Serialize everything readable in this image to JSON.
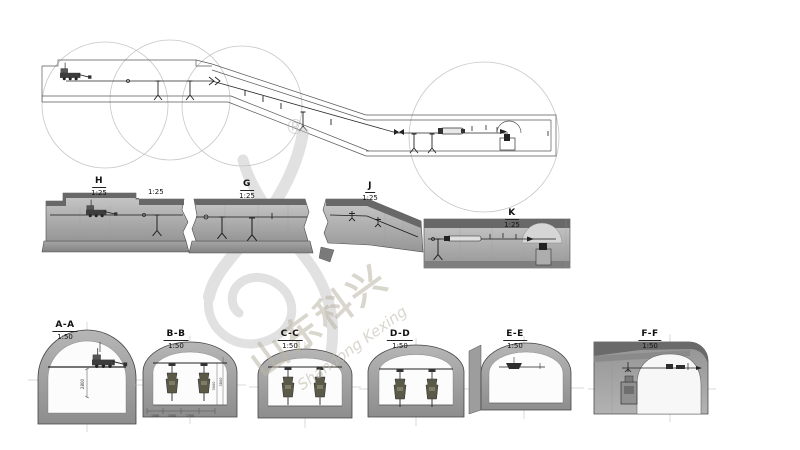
{
  "watermark": {
    "registered_mark": "®",
    "brand_cn": "山东科兴",
    "brand_en": "Shandong Kexing"
  },
  "plan": {
    "extra_scale_label": "1:25"
  },
  "detail_sections": [
    {
      "title": "H",
      "scale": "1:25"
    },
    {
      "title": "G",
      "scale": "1:25"
    },
    {
      "title": "J",
      "scale": "1:25"
    },
    {
      "title": "K",
      "scale": "1:25"
    }
  ],
  "cross_sections": [
    {
      "title": "A-A",
      "scale": "1:50"
    },
    {
      "title": "B-B",
      "scale": "1:50"
    },
    {
      "title": "C-C",
      "scale": "1:50"
    },
    {
      "title": "D-D",
      "scale": "1:50"
    },
    {
      "title": "E-E",
      "scale": "1:50"
    },
    {
      "title": "F-F",
      "scale": "1:50"
    }
  ],
  "dimensions": {
    "aa_height": "2800",
    "bb_right": [
      "3000",
      "3800"
    ],
    "bb_bottom": [
      "1500",
      "1000",
      "1700"
    ]
  }
}
